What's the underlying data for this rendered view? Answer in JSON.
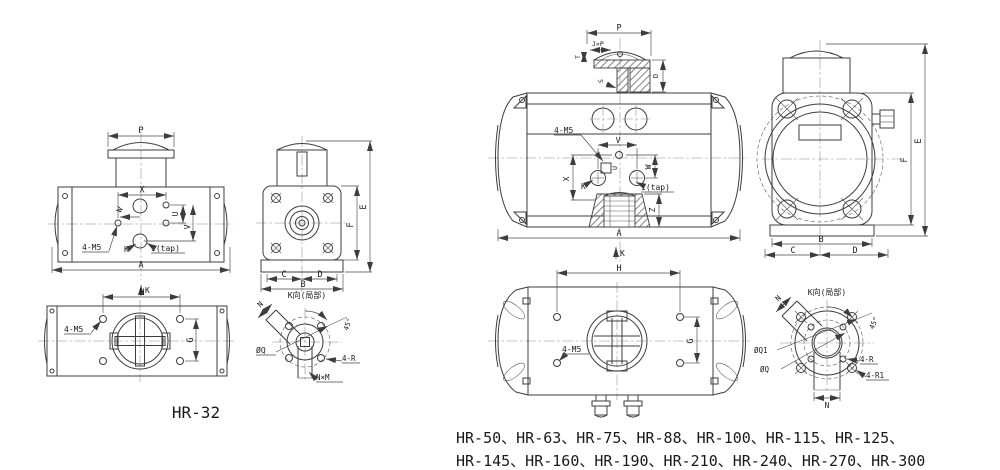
{
  "drawing": {
    "bg": "#ffffff",
    "line_color": "#3d3d3d"
  },
  "fig1": {
    "model_label": "HR-32",
    "front": {
      "p": "P",
      "x": "X",
      "w": "W",
      "u": "U",
      "v": "V",
      "k": "K",
      "i_tap": "I(tap)",
      "m5": "4-M5",
      "a": "A",
      "k_dir": "K"
    },
    "side": {
      "c": "C",
      "d": "D",
      "b": "B",
      "e": "E",
      "f": "F"
    },
    "top": {
      "h": "H",
      "g": "G",
      "m5": "4-M5"
    },
    "detail": {
      "title": "K向(局部)",
      "n": "N",
      "angle": "45°",
      "q": "ØQ",
      "r": "4-R",
      "nxm": "N×M"
    }
  },
  "fig2": {
    "models_line1": "HR-50、HR-63、HR-75、HR-88、HR-100、HR-115、HR-125、",
    "models_line2": "HR-145、HR-160、HR-190、HR-210、HR-240、HR-270、HR-300",
    "front": {
      "p": "P",
      "jxp": "J×P",
      "t": "T",
      "s": "S",
      "d": "D",
      "v": "V",
      "u": "U",
      "x": "X",
      "w": "W",
      "z": "Z",
      "k": "K",
      "i_tap": "I(tap)",
      "m5": "4-M5",
      "a": "A",
      "k_dir": "K"
    },
    "side": {
      "b": "B",
      "c": "C",
      "d": "D",
      "e": "E",
      "f": "F"
    },
    "top": {
      "h": "H",
      "g": "G",
      "m5": "4-M5",
      "k_dir": "K"
    },
    "detail": {
      "title": "K向(局部)",
      "n_slot": "N",
      "n_bottom": "N",
      "angle": "45°",
      "q1": "ØQ1",
      "q": "ØQ",
      "r": "4-R",
      "r1": "4-R1"
    }
  }
}
